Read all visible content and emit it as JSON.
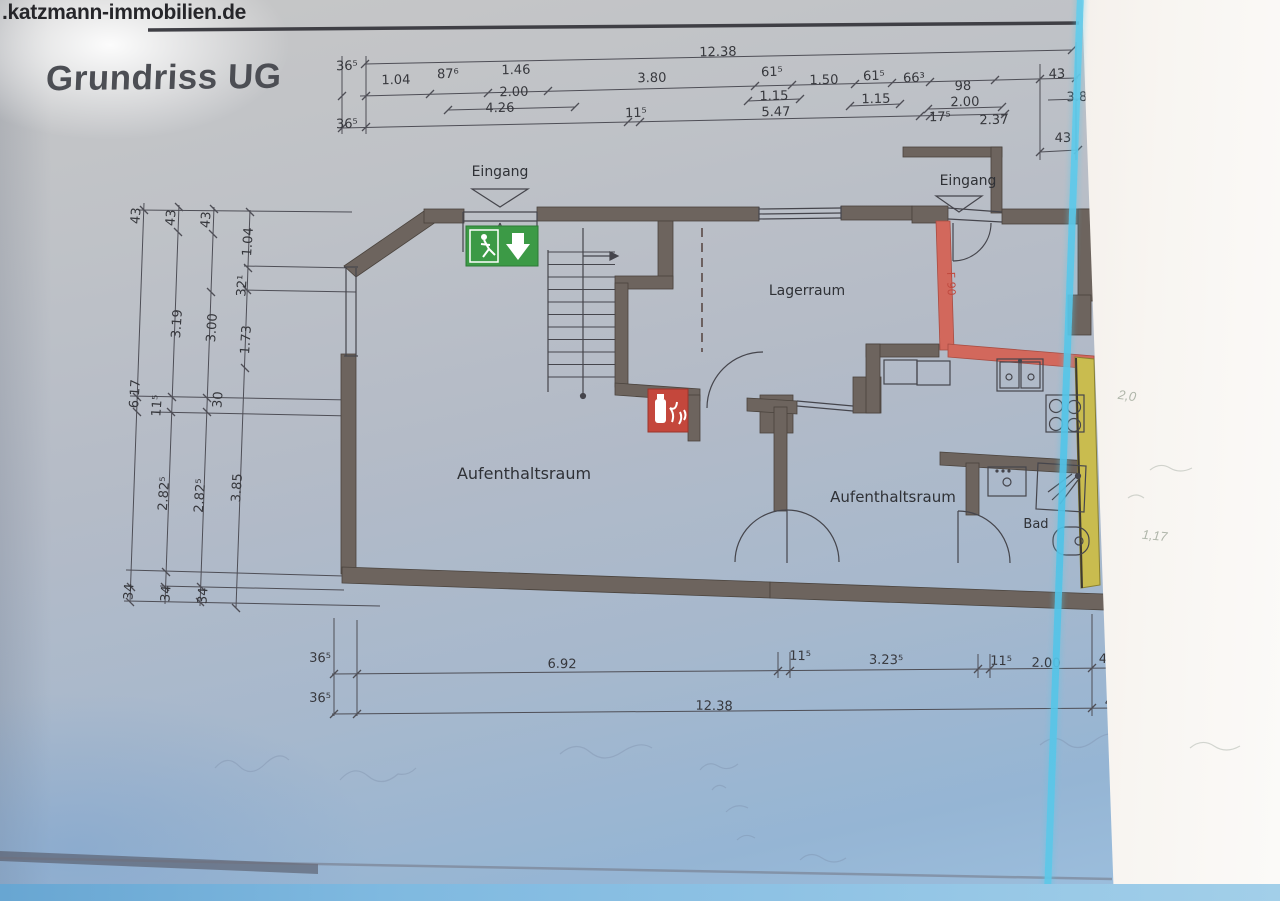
{
  "page": {
    "watermark": ".katzmann-immobilien.de",
    "title": "Grundriss UG"
  },
  "colors": {
    "wall": "#6d645e",
    "fire_wall_red": "#d2685c",
    "highlight_yellow": "#c9bc4f",
    "exit_sign_green": "#3c9a46",
    "extinguisher_red": "#c4473c",
    "scan_edge_cyan": "#58c8ea",
    "paper_blue": "#a6b8cd",
    "dim_text": "#36373c"
  },
  "rooms": [
    {
      "t": "Eingang",
      "x": 500,
      "y": 176,
      "size": 14
    },
    {
      "t": "Eingang",
      "x": 968,
      "y": 185,
      "size": 14
    },
    {
      "t": "Lagerraum",
      "x": 807,
      "y": 295,
      "size": 14
    },
    {
      "t": "Aufenthaltsraum",
      "x": 524,
      "y": 479,
      "size": 16
    },
    {
      "t": "Aufenthaltsraum",
      "x": 893,
      "y": 502,
      "size": 15
    },
    {
      "t": "Bad",
      "x": 1036,
      "y": 528,
      "size": 13
    }
  ],
  "fire_rating_label": {
    "t": "F 90"
  },
  "dimensions": {
    "top": [
      {
        "t": "12.38",
        "x": 718,
        "y": 56
      },
      {
        "t": "36⁵",
        "x": 347,
        "y": 70
      },
      {
        "t": "1.04",
        "x": 396,
        "y": 84
      },
      {
        "t": "87⁶",
        "x": 448,
        "y": 78
      },
      {
        "t": "1.46",
        "x": 516,
        "y": 74
      },
      {
        "t": "3.80",
        "x": 652,
        "y": 82
      },
      {
        "t": "61⁵",
        "x": 772,
        "y": 76
      },
      {
        "t": "1.50",
        "x": 824,
        "y": 84
      },
      {
        "t": "61⁵",
        "x": 874,
        "y": 80
      },
      {
        "t": "66³",
        "x": 914,
        "y": 82
      },
      {
        "t": "98",
        "x": 963,
        "y": 90
      },
      {
        "t": "43",
        "x": 1057,
        "y": 78
      },
      {
        "t": "2.00",
        "x": 514,
        "y": 96
      },
      {
        "t": "1.15",
        "x": 774,
        "y": 100
      },
      {
        "t": "1.15",
        "x": 876,
        "y": 103
      },
      {
        "t": "2.00",
        "x": 965,
        "y": 106
      },
      {
        "t": "3.8",
        "x": 1077,
        "y": 101
      },
      {
        "t": "36⁵",
        "x": 347,
        "y": 128
      },
      {
        "t": "4.26",
        "x": 500,
        "y": 112
      },
      {
        "t": "11⁵",
        "x": 636,
        "y": 117
      },
      {
        "t": "5.47",
        "x": 776,
        "y": 116
      },
      {
        "t": "17⁵",
        "x": 940,
        "y": 121
      },
      {
        "t": "2.37",
        "x": 994,
        "y": 124
      },
      {
        "t": "43",
        "x": 1063,
        "y": 142
      }
    ],
    "left": [
      {
        "t": "43",
        "x": 140,
        "y": 216,
        "r": -86
      },
      {
        "t": "43",
        "x": 175,
        "y": 218,
        "r": -86
      },
      {
        "t": "43",
        "x": 210,
        "y": 220,
        "r": -86
      },
      {
        "t": "1.04",
        "x": 252,
        "y": 242,
        "r": -86
      },
      {
        "t": "32¹",
        "x": 246,
        "y": 286,
        "r": -86
      },
      {
        "t": "3.19",
        "x": 181,
        "y": 324,
        "r": -86
      },
      {
        "t": "3.00",
        "x": 216,
        "y": 328,
        "r": -86
      },
      {
        "t": "1.73",
        "x": 250,
        "y": 340,
        "r": -86
      },
      {
        "t": "6.17",
        "x": 139,
        "y": 394,
        "r": -86
      },
      {
        "t": "11⁵",
        "x": 161,
        "y": 406,
        "r": -86
      },
      {
        "t": "30",
        "x": 222,
        "y": 400,
        "r": -86
      },
      {
        "t": "2.82⁵",
        "x": 168,
        "y": 494,
        "r": -86
      },
      {
        "t": "2.82⁵",
        "x": 204,
        "y": 496,
        "r": -86
      },
      {
        "t": "3.85",
        "x": 241,
        "y": 488,
        "r": -86
      },
      {
        "t": "34",
        "x": 133,
        "y": 592,
        "r": -86
      },
      {
        "t": "34",
        "x": 170,
        "y": 594,
        "r": -86
      },
      {
        "t": "34",
        "x": 207,
        "y": 596,
        "r": -86
      }
    ],
    "bottom": [
      {
        "t": "36⁵",
        "x": 320,
        "y": 662,
        "r": 1
      },
      {
        "t": "6.92",
        "x": 562,
        "y": 668,
        "r": 1
      },
      {
        "t": "11⁵",
        "x": 800,
        "y": 660,
        "r": 1
      },
      {
        "t": "3.23⁵",
        "x": 886,
        "y": 664,
        "r": 1
      },
      {
        "t": "11⁵",
        "x": 1001,
        "y": 665,
        "r": 1
      },
      {
        "t": "2.00",
        "x": 1046,
        "y": 667,
        "r": 1
      },
      {
        "t": "43",
        "x": 1107,
        "y": 663,
        "r": 1
      },
      {
        "t": "36⁵",
        "x": 320,
        "y": 702,
        "r": 1
      },
      {
        "t": "12.38",
        "x": 714,
        "y": 710,
        "r": 1
      },
      {
        "t": "43",
        "x": 1113,
        "y": 706,
        "r": 1
      }
    ]
  },
  "handwritten_notes": [
    {
      "t": "2,0",
      "x": 1118,
      "y": 388,
      "r": 8
    },
    {
      "t": "1,17",
      "x": 1142,
      "y": 528,
      "r": 6
    }
  ]
}
